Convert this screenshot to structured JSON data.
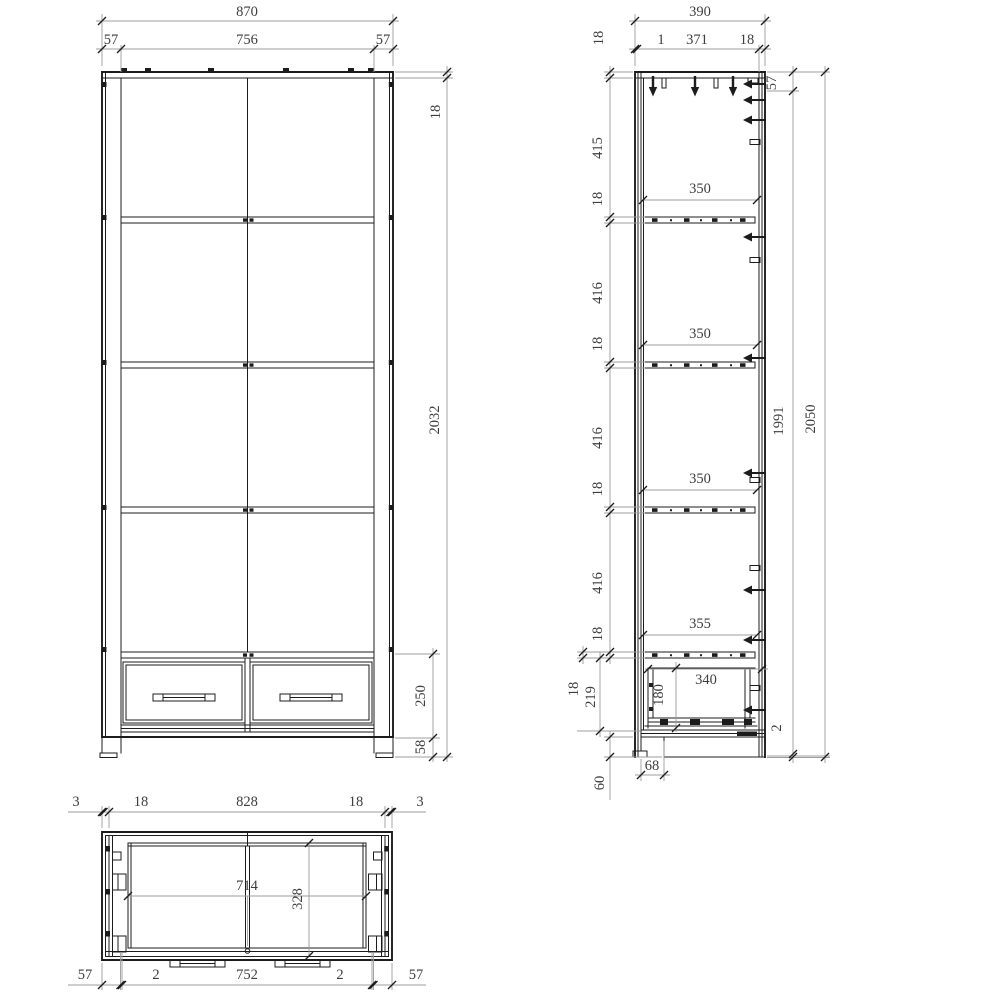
{
  "colors": {
    "background": "#ffffff",
    "line": "#1c1c1c",
    "dim_line": "#9c9c9c",
    "text": "#3e3e3e"
  },
  "front_view": {
    "total_width": "870",
    "left_side": "57",
    "opening_width": "756",
    "right_side": "57",
    "top_panel_thickness": "18",
    "carcass_height": "2032",
    "drawer_front_height": "250",
    "plinth_height": "58"
  },
  "side_view": {
    "total_depth": "390",
    "back_panel_gap": "1",
    "inner_depth": "371",
    "wall_thickness": "18",
    "left_chain": [
      "18",
      "415",
      "18",
      "416",
      "18",
      "416",
      "18",
      "416",
      "18"
    ],
    "shelf_depths": [
      "350",
      "350",
      "350",
      "355"
    ],
    "drawer_depth": "340",
    "drawer_inner_height": "180",
    "bottom_shelf_thickness": "18",
    "drawer_section_height": "219",
    "plinth_height": "60",
    "plinth_recess": "68",
    "top_offset": "57",
    "interior_height": "1991",
    "total_height": "2050",
    "bottom_gap": "2"
  },
  "top_view": {
    "edge_dims": [
      "3",
      "18",
      "828",
      "18",
      "3"
    ],
    "opening_width": "714",
    "inner_depth": "328",
    "bottom_dims": [
      "57",
      "2",
      "752",
      "2",
      "57"
    ]
  }
}
